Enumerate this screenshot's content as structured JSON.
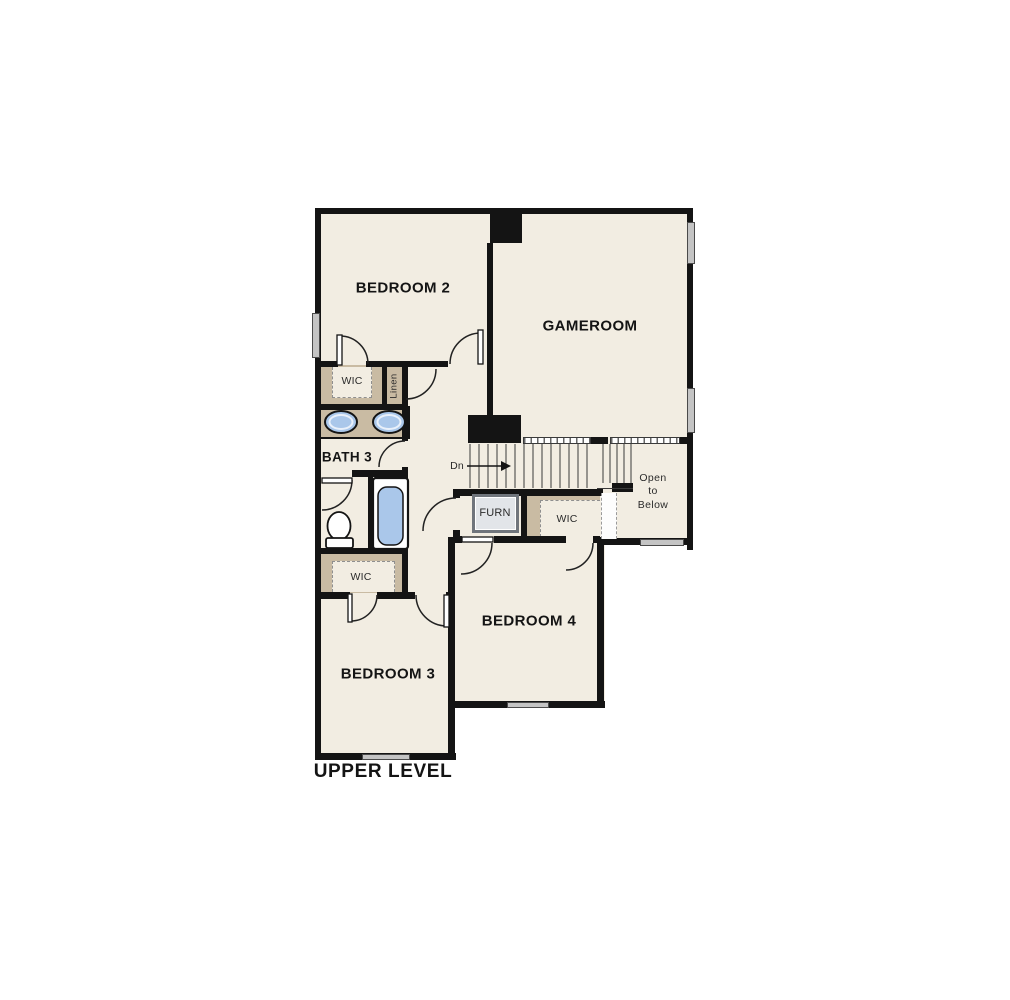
{
  "title": "UPPER LEVEL",
  "colors": {
    "floor": "#f2ede2",
    "wall": "#141414",
    "closet_tan": "#c9bba3",
    "fixture_blue": "#aac7ea",
    "window_gray": "#c4c4c4",
    "furnace_gray": "#e2e5e9"
  },
  "rooms": {
    "bedroom2": "BEDROOM 2",
    "gameroom": "GAMEROOM",
    "bath3": "BATH 3",
    "bedroom4": "BEDROOM 4",
    "bedroom3": "BEDROOM 3"
  },
  "closets": {
    "wic_bed2": "WIC",
    "wic_bed4": "WIC",
    "wic_bed3": "WIC",
    "linen": "Linen"
  },
  "stairs": {
    "down_label": "Dn"
  },
  "utility": {
    "furnace": "FURN"
  },
  "open_to_below": {
    "line1": "Open",
    "line2": "to",
    "line3": "Below"
  }
}
